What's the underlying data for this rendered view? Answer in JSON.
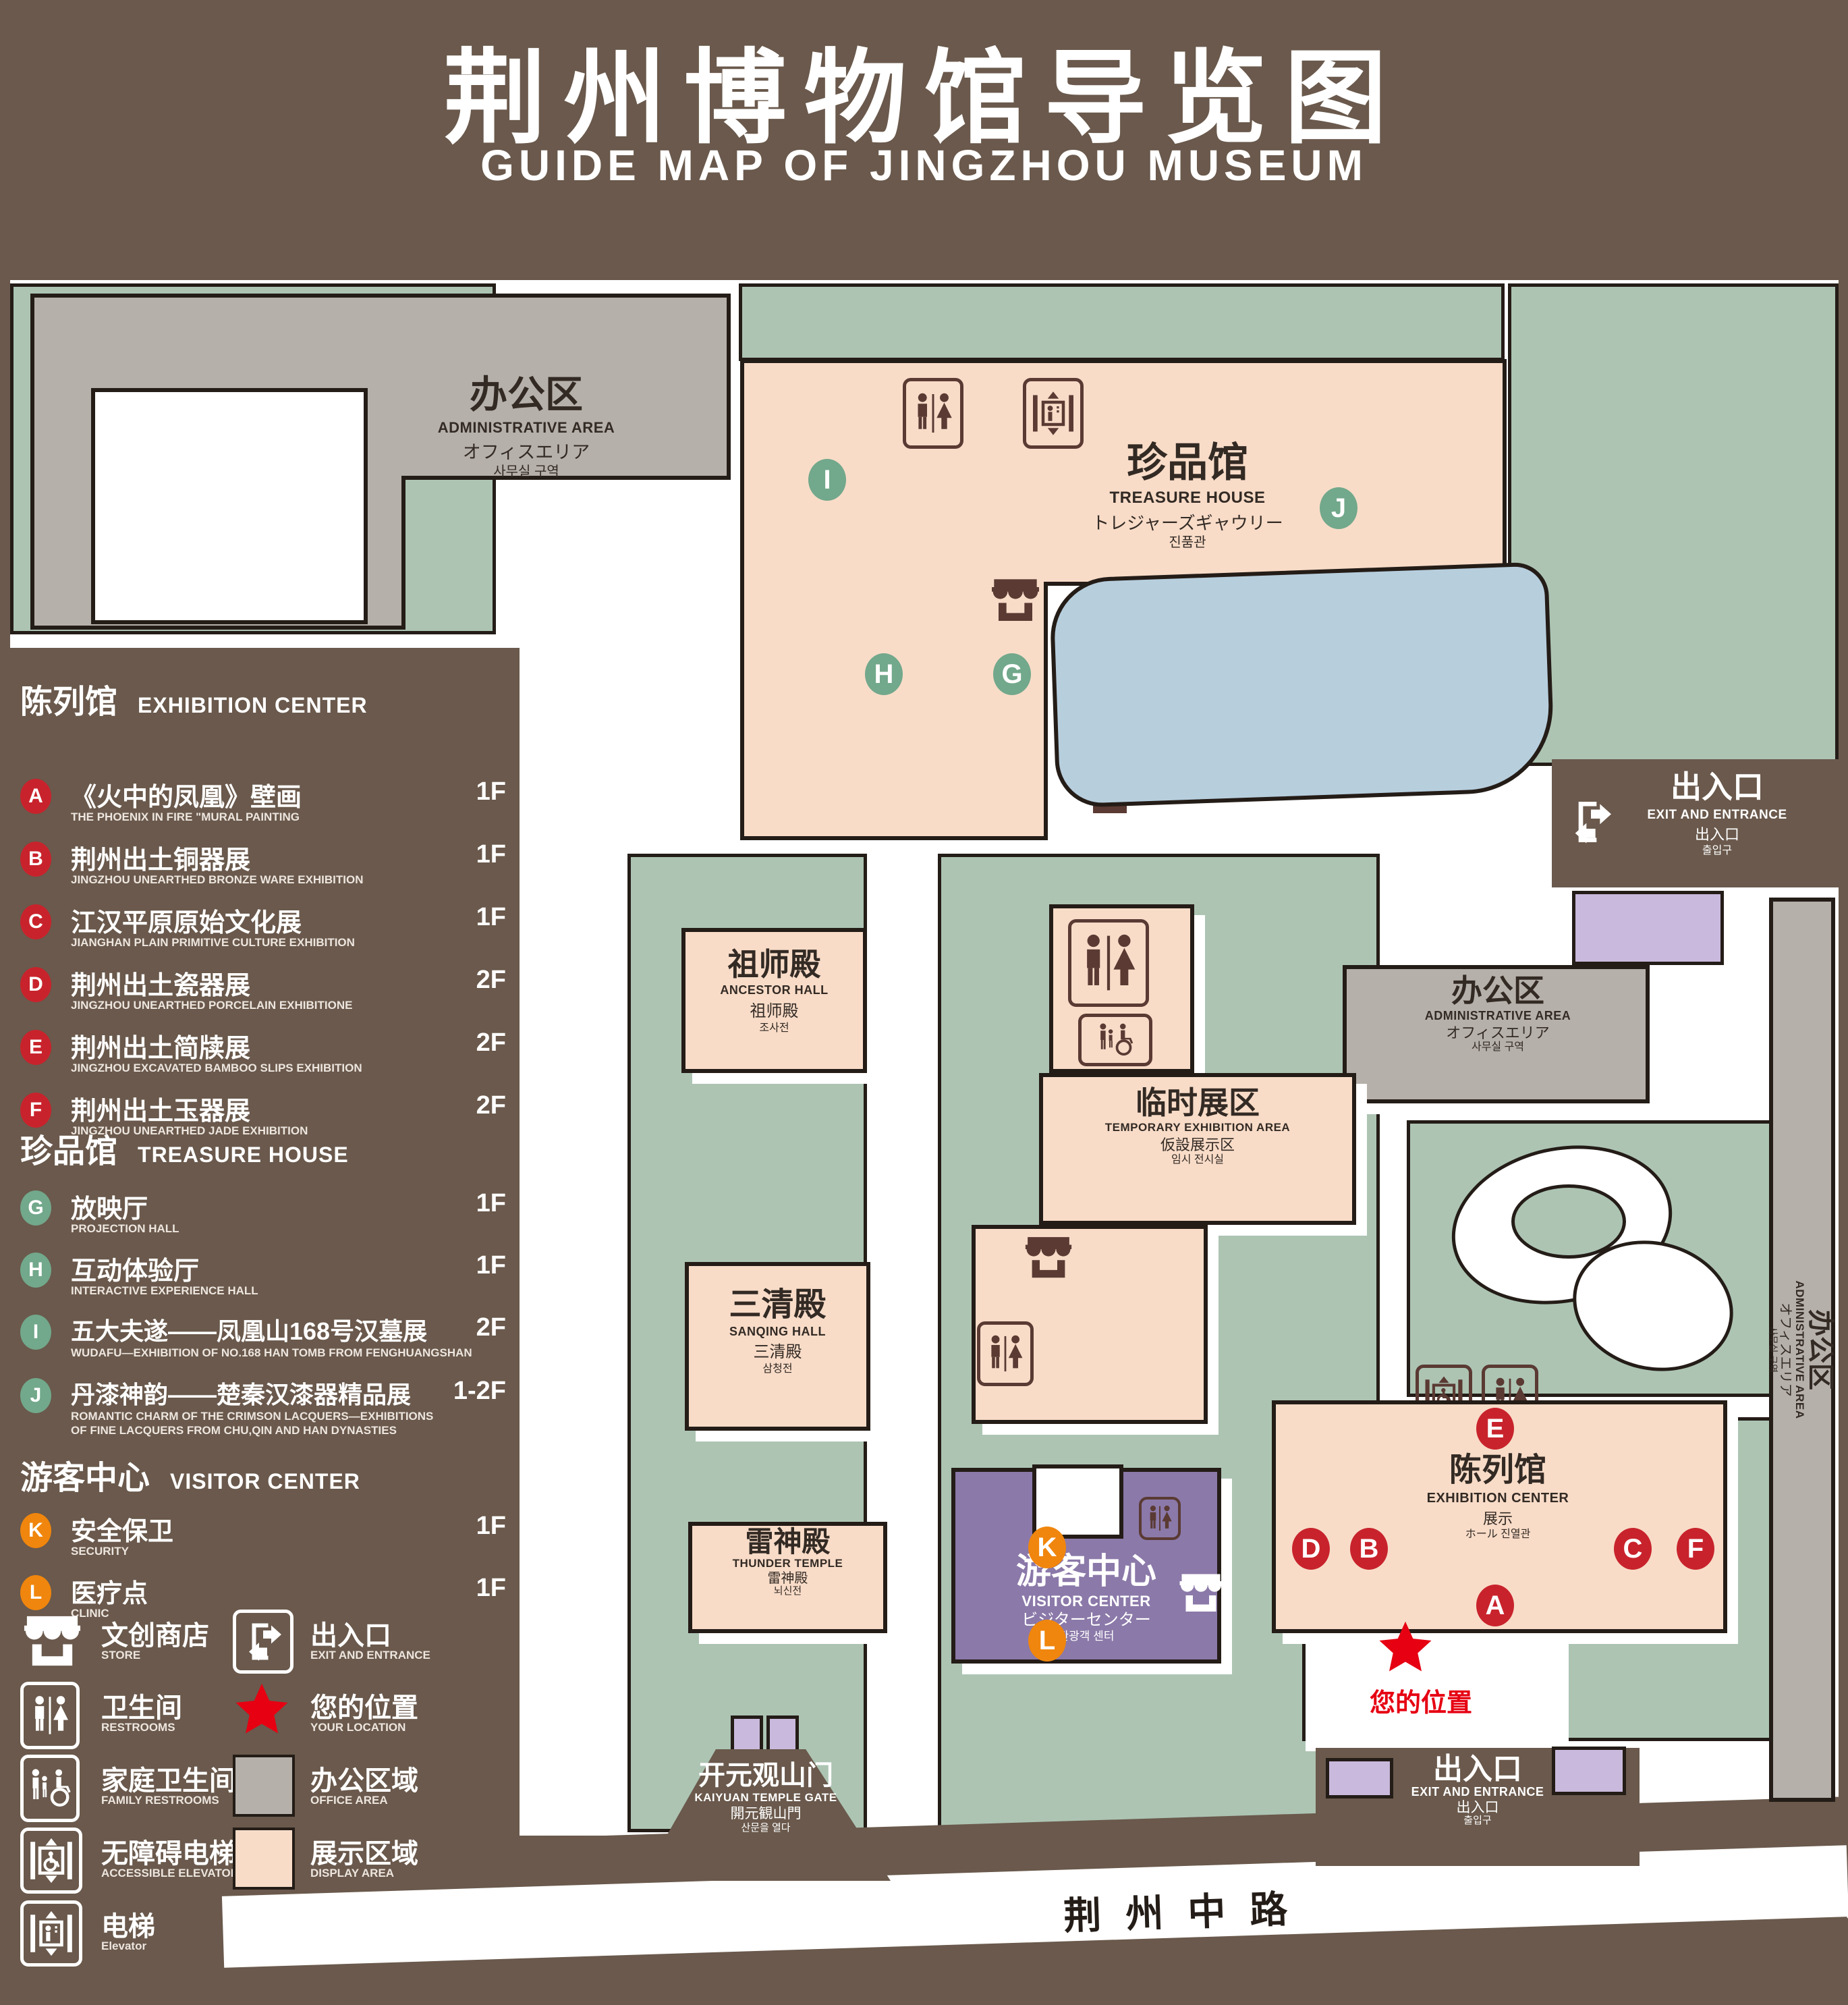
{
  "title": {
    "zh": "荆州博物馆导览图",
    "en": "GUIDE MAP OF JINGZHOU MUSEUM"
  },
  "colors": {
    "background": "#6A594C",
    "green_area": "#ADC4B3",
    "display_area": "#F8DCC8",
    "office_area": "#B6B0AB",
    "pond": "#B7CEDD",
    "visitor_center_purple": "#8B79A9",
    "purple_building": "#C9B9DC",
    "marker_red": "#C8232C",
    "marker_green": "#72A88B",
    "marker_orange": "#F0860D",
    "location_red": "#E60012"
  },
  "legend_sections": {
    "exhibition": {
      "zh": "陈列馆",
      "en": "EXHIBITION CENTER",
      "items": [
        {
          "id": "A",
          "zh": "《火中的凤凰》壁画",
          "en": "THE PHOENIX IN FIRE \"MURAL PAINTING",
          "floor": "1F"
        },
        {
          "id": "B",
          "zh": "荆州出土铜器展",
          "en": "JINGZHOU UNEARTHED BRONZE WARE EXHIBITION",
          "floor": "1F"
        },
        {
          "id": "C",
          "zh": "江汉平原原始文化展",
          "en": "JIANGHAN PLAIN PRIMITIVE CULTURE EXHIBITION",
          "floor": "1F"
        },
        {
          "id": "D",
          "zh": "荆州出土瓷器展",
          "en": "JINGZHOU UNEARTHED PORCELAIN EXHIBITIONE",
          "floor": "2F"
        },
        {
          "id": "E",
          "zh": "荆州出土简牍展",
          "en": "JINGZHOU EXCAVATED BAMBOO SLIPS EXHIBITION",
          "floor": "2F"
        },
        {
          "id": "F",
          "zh": "荆州出土玉器展",
          "en": "JINGZHOU UNEARTHED JADE EXHIBITION",
          "floor": "2F"
        }
      ]
    },
    "treasure": {
      "zh": "珍品馆",
      "en": "TREASURE HOUSE",
      "items": [
        {
          "id": "G",
          "zh": "放映厅",
          "en": "PROJECTION HALL",
          "floor": "1F"
        },
        {
          "id": "H",
          "zh": "互动体验厅",
          "en": "INTERACTIVE EXPERIENCE HALL",
          "floor": "1F"
        },
        {
          "id": "I",
          "zh": "五大夫遂——凤凰山168号汉墓展",
          "en": "WUDAFU—EXHIBITION OF NO.168 HAN TOMB FROM FENGHUANGSHAN",
          "floor": "2F"
        },
        {
          "id": "J",
          "zh": "丹漆神韵——楚秦汉漆器精品展",
          "en": "ROMANTIC CHARM OF THE CRIMSON LACQUERS—EXHIBITIONS OF FINE LACQUERS FROM CHU,QIN AND HAN DYNASTIES",
          "floor": "1-2F"
        }
      ]
    },
    "visitor": {
      "zh": "游客中心",
      "en": "VISITOR CENTER",
      "items": [
        {
          "id": "K",
          "zh": "安全保卫",
          "en": "SECURITY",
          "floor": "1F"
        },
        {
          "id": "L",
          "zh": "医疗点",
          "en": "CLINIC",
          "floor": "1F"
        }
      ]
    }
  },
  "legend_icons": {
    "store": {
      "zh": "文创商店",
      "en": "STORE"
    },
    "restrooms": {
      "zh": "卫生间",
      "en": "RESTROOMS"
    },
    "family_restrooms": {
      "zh": "家庭卫生间",
      "en": "FAMILY RESTROOMS"
    },
    "accessible_elevator": {
      "zh": "无障碍电梯",
      "en": "ACCESSIBLE ELEVATOR"
    },
    "elevator": {
      "zh": "电梯",
      "en": "Elevator"
    },
    "exit": {
      "zh": "出入口",
      "en": "EXIT AND ENTRANCE"
    },
    "your_location": {
      "zh": "您的位置",
      "en": "YOUR LOCATION"
    },
    "office_area": {
      "zh": "办公区域",
      "en": "OFFICE AREA"
    },
    "display_area": {
      "zh": "展示区域",
      "en": "DISPLAY AREA"
    }
  },
  "map": {
    "admin": {
      "zh": "办公区",
      "en": "ADMINISTRATIVE AREA",
      "jp": "オフィスエリア",
      "kr": "사무실 구역"
    },
    "treasure_house": {
      "zh": "珍品馆",
      "en": "TREASURE HOUSE",
      "jp": "トレジャーズギャウリー",
      "kr": "진품관"
    },
    "ancestor_hall": {
      "zh": "祖师殿",
      "en": "ANCESTOR HALL",
      "jp": "祖师殿",
      "kr": "조사전"
    },
    "temporary_exhibition": {
      "zh": "临时展区",
      "en": "TEMPORARY EXHIBITION AREA",
      "jp": "仮設展示区",
      "kr": "임시 전시실"
    },
    "sanqing_hall": {
      "zh": "三清殿",
      "en": "SANQING HALL",
      "jp": "三清殿",
      "kr": "삼청전"
    },
    "thunder_temple": {
      "zh": "雷神殿",
      "en": "THUNDER TEMPLE",
      "jp": "雷神殿",
      "kr": "뇌신전"
    },
    "visitor_center": {
      "zh": "游客中心",
      "en": "VISITOR CENTER",
      "jp": "ビジターセンター",
      "kr": "관광객 센터"
    },
    "exhibition_center": {
      "zh": "陈列馆",
      "en": "EXHIBITION CENTER",
      "l3": "展示",
      "l4": "ホール 진열관"
    },
    "kaiyuan_gate": {
      "zh": "开元观山门",
      "en": "KAIYUAN TEMPLE GATE",
      "jp": "開元観山門",
      "kr": "산문을 열다"
    },
    "exit": {
      "zh": "出入口",
      "en": "EXIT AND ENTRANCE",
      "jp": "出入口",
      "kr": "출입구"
    },
    "road_name": "荆州中路",
    "your_location": "您的位置",
    "markers": {
      "A": "A",
      "B": "B",
      "C": "C",
      "D": "D",
      "E": "E",
      "F": "F",
      "G": "G",
      "H": "H",
      "I": "I",
      "J": "J",
      "K": "K",
      "L": "L"
    }
  }
}
